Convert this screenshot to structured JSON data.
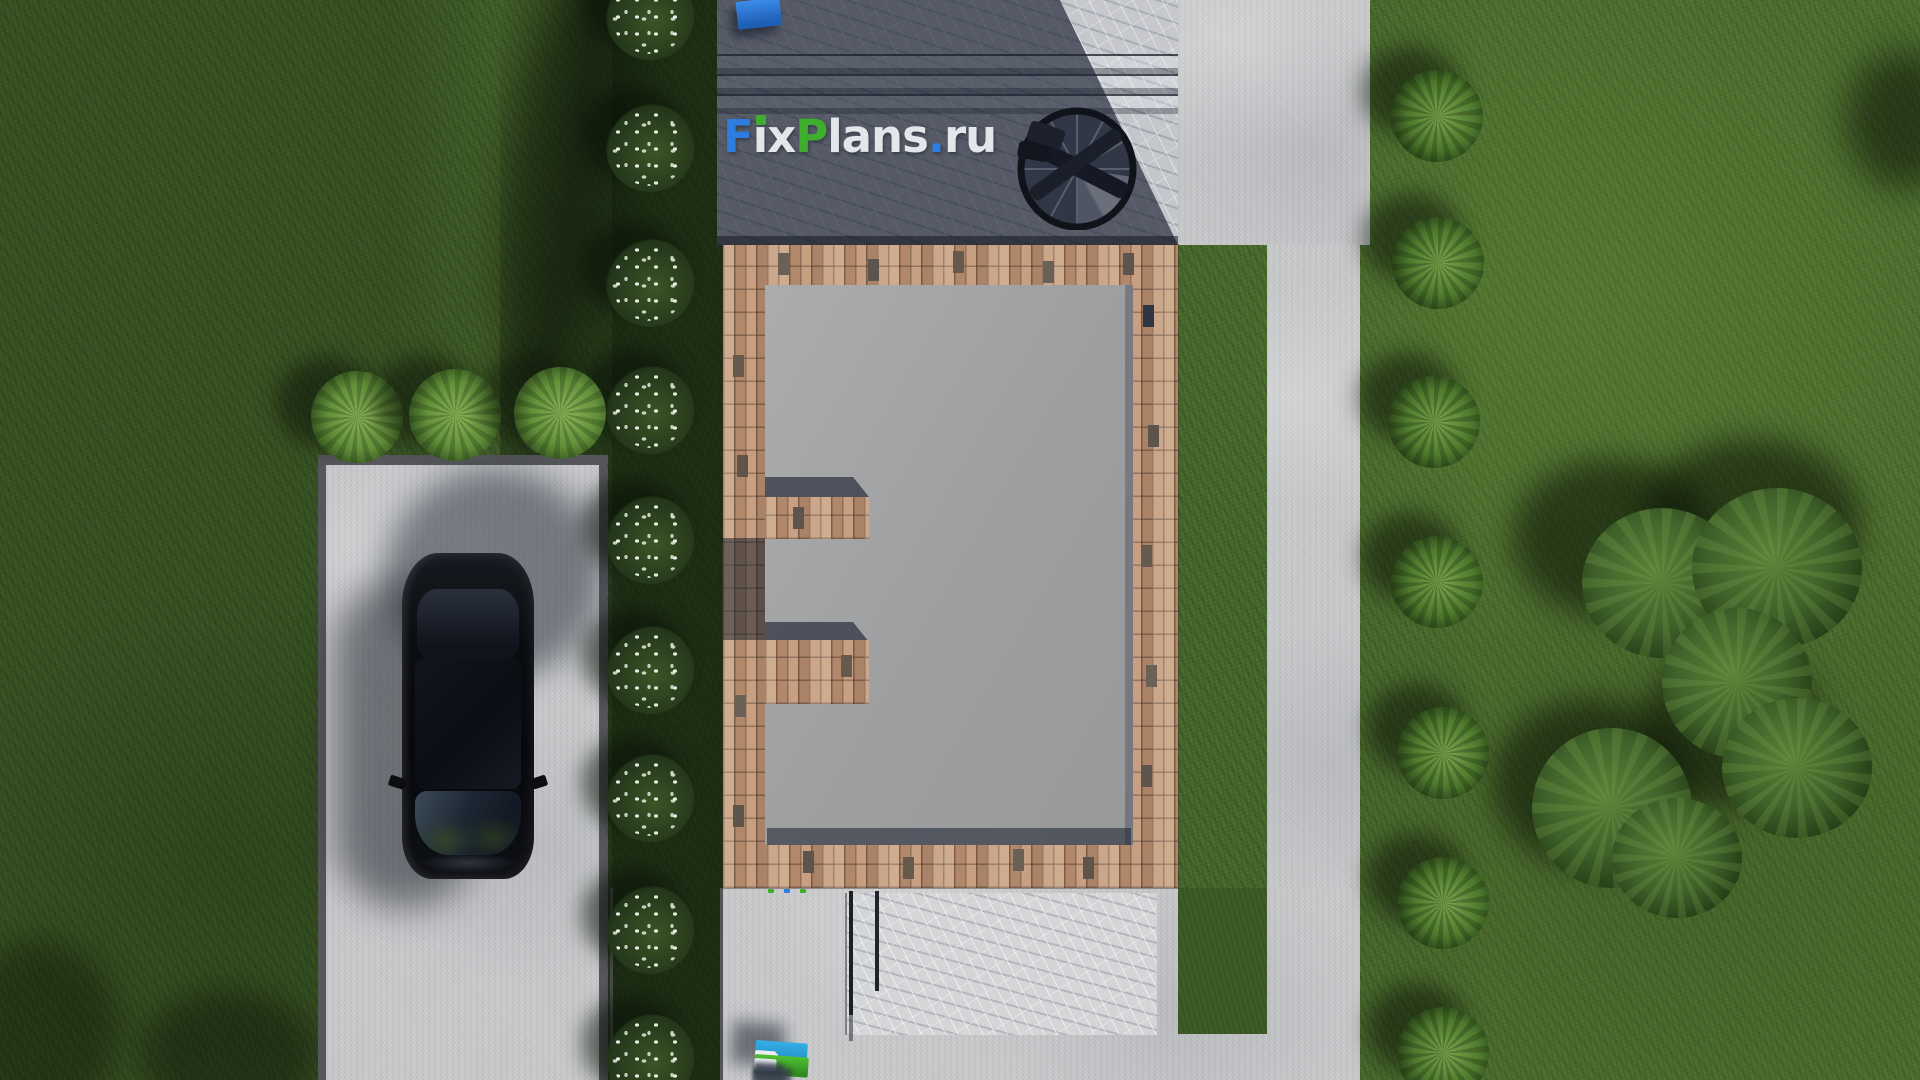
{
  "meta": {
    "site_brand": "FixPlans.ru",
    "view": "top-down 3D architectural site render of a brick house, driveway with car, terraces and garden"
  },
  "watermark": {
    "text": "FixPlans.ru",
    "letters": [
      {
        "ch": "F",
        "color": "#2e7ce0"
      },
      {
        "ch": "i",
        "color": "#e3e6ea",
        "dot_color": "#3fae2e"
      },
      {
        "ch": "x",
        "color": "#e3e6ea"
      },
      {
        "ch": "P",
        "color": "#3fae2e"
      },
      {
        "ch": "l",
        "color": "#e3e6ea"
      },
      {
        "ch": "a",
        "color": "#e3e6ea"
      },
      {
        "ch": "n",
        "color": "#e3e6ea"
      },
      {
        "ch": "s",
        "color": "#e3e6ea"
      },
      {
        "ch": ".",
        "color": "#2e7ce0"
      },
      {
        "ch": "r",
        "color": "#e3e6ea"
      },
      {
        "ch": "u",
        "color": "#e3e6ea"
      }
    ]
  },
  "signs": {
    "flat_watermark": "FixPlans.ru",
    "standing_3d_top": "FixPlans.ru",
    "standing_3d_bottom": "FixPlans.ru"
  },
  "palette": {
    "logo_blue": "#2e7ce0",
    "logo_green": "#3fae2e",
    "logo_white": "#e3e6ea",
    "grass_lit": "#4a6a2d",
    "grass_shadow": "#24371b",
    "brick_wall": "#c09678",
    "slate_terrace_shadow": "#454c5e",
    "marble_lit": "#c3c6cb",
    "concrete": "#cacbcd",
    "interior_floor": "#a2a3a5",
    "car_black": "#0b0d12"
  }
}
